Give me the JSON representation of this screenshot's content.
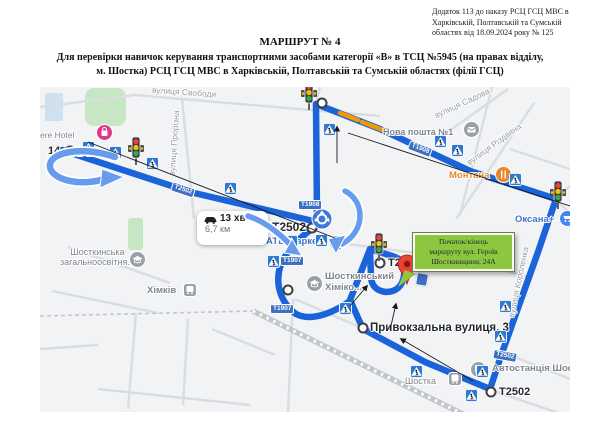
{
  "doc": {
    "annotation": [
      "Додаток 113 до наказу РСЦ ГСЦ МВС в",
      "Харківській, Полтавській та Сумській",
      "областях від 18.09.2024 року № 125"
    ],
    "title": "МАРШРУТ № 4",
    "subtitle": [
      "Для перевірки навичок керування транспортними засобами категорії «В» в ТСЦ №5945 (на правах відділу,",
      "м. Шостка) РСЦ ГСЦ МВС в Харківській, Полтавській та Сумській областях (філії ГСЦ)"
    ]
  },
  "map": {
    "streets": [
      {
        "name": "вулиця Свободи"
      },
      {
        "name": "вулиця Прорізна"
      },
      {
        "name": "вулиця Садова"
      },
      {
        "name": "вулиця Різдвяна"
      },
      {
        "name": "вулиця Короленка"
      }
    ],
    "pois": [
      {
        "name": "АТБ-Маркет"
      },
      {
        "name": "ere Hotel"
      },
      {
        "name": "Нова пошта №1"
      },
      {
        "name": "Монтана"
      },
      {
        "name": "Оксана+"
      },
      {
        "line1": "Шосткинський",
        "line2": "Хіміко..."
      },
      {
        "line1": "Шосткинська",
        "line2": "загальноосвітня..."
      },
      {
        "name": "Хімків"
      },
      {
        "name": "Шостка"
      },
      {
        "name": "Автостанція Шостка"
      }
    ],
    "shields": [
      {
        "text": "Т2502"
      },
      {
        "text": "Т1908"
      },
      {
        "text": "Т1908"
      },
      {
        "text": "Т1907"
      },
      {
        "text": "Т1907"
      },
      {
        "text": "Т2502"
      }
    ],
    "waypoint_labels": [
      {
        "text": "Т2502"
      },
      {
        "text": "Т2608"
      },
      {
        "text": "Т2502"
      },
      {
        "text": "14"
      },
      {
        "text": "Привокзальна вулиця, 3"
      }
    ],
    "route_info": {
      "duration": "13 хв",
      "distance": "6,7 км"
    },
    "start_callout": {
      "lines": [
        "Початок/кінець",
        "маршруту вул. Героїв",
        "Шосткинщини, 24А"
      ]
    },
    "colors": {
      "route": "#1b63d8",
      "callout_green": "#8dc63f",
      "crossing_blue": "#2e7ad2",
      "shield_blue": "#3e6fc0",
      "traffic_orange": "#f29900"
    }
  }
}
